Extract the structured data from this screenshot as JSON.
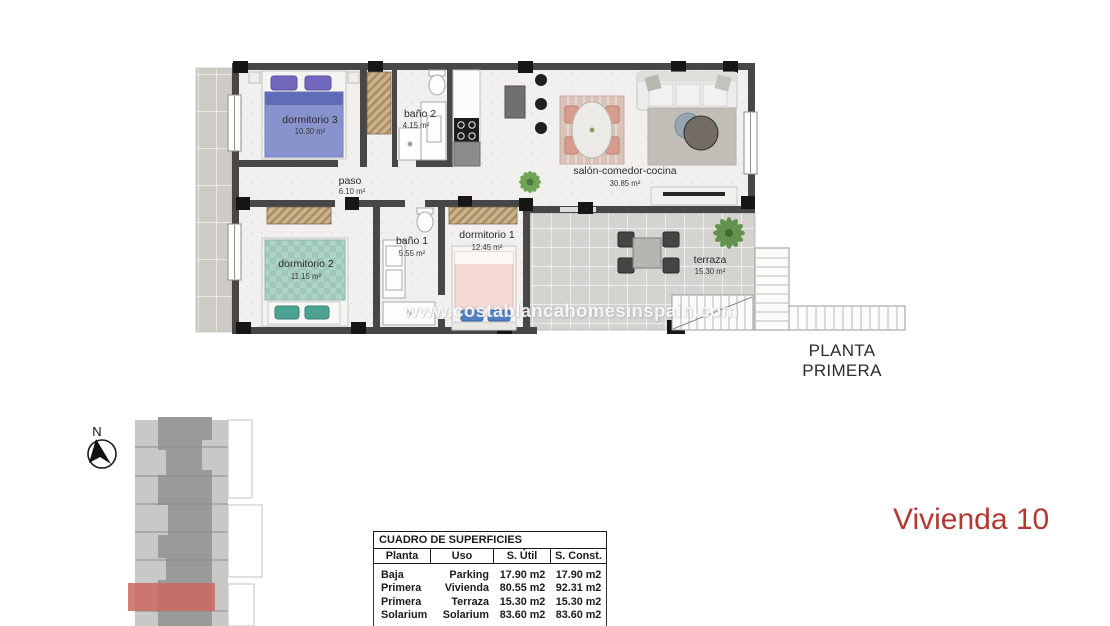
{
  "plan": {
    "caption": "PLANTA PRIMERA",
    "watermark": "www.costablancahomesinspain.com",
    "rooms": [
      {
        "name": "dormitorio 3",
        "area": "10.30 m²"
      },
      {
        "name": "baño 2",
        "area": "4.15 m²"
      },
      {
        "name": "paso",
        "area": "6.10 m²"
      },
      {
        "name": "salón-comedor-cocina",
        "area": "30.85 m²"
      },
      {
        "name": "dormitorio 2",
        "area": "11.15 m²"
      },
      {
        "name": "baño 1",
        "area": "5.55 m²"
      },
      {
        "name": "dormitorio 1",
        "area": "12.45 m²"
      },
      {
        "name": "terraza",
        "area": "15.30 m²"
      }
    ]
  },
  "compass": {
    "north_label": "N"
  },
  "site_plan": {
    "highlight_color": "#cb6760"
  },
  "unit_label": {
    "text": "Vivienda 10",
    "color": "#b23931"
  },
  "surfaces_table": {
    "title": "CUADRO DE SUPERFICIES",
    "headers": [
      "Planta",
      "Uso",
      "S. Útil",
      "S. Const."
    ],
    "rows": [
      [
        "Baja",
        "Parking",
        "17.90 m2",
        "17.90 m2"
      ],
      [
        "Primera",
        "Vivienda",
        "80.55 m2",
        "92.31 m2"
      ],
      [
        "Primera",
        "Terraza",
        "15.30 m2",
        "15.30 m2"
      ],
      [
        "Solarium",
        "Solarium",
        "83.60 m2",
        "83.60 m2"
      ]
    ]
  },
  "colors": {
    "wall": "#474747",
    "column": "#161616",
    "floor_speckle": "#f1f0ee",
    "terrace_tile": "#d5d3d0",
    "bed_blue": "#8893cd",
    "bed_green": "#aed2c6",
    "bed_pink": "#f3d8d4",
    "wardrobe_hatch": "#cbb48d",
    "accent_red": "#b23931"
  }
}
